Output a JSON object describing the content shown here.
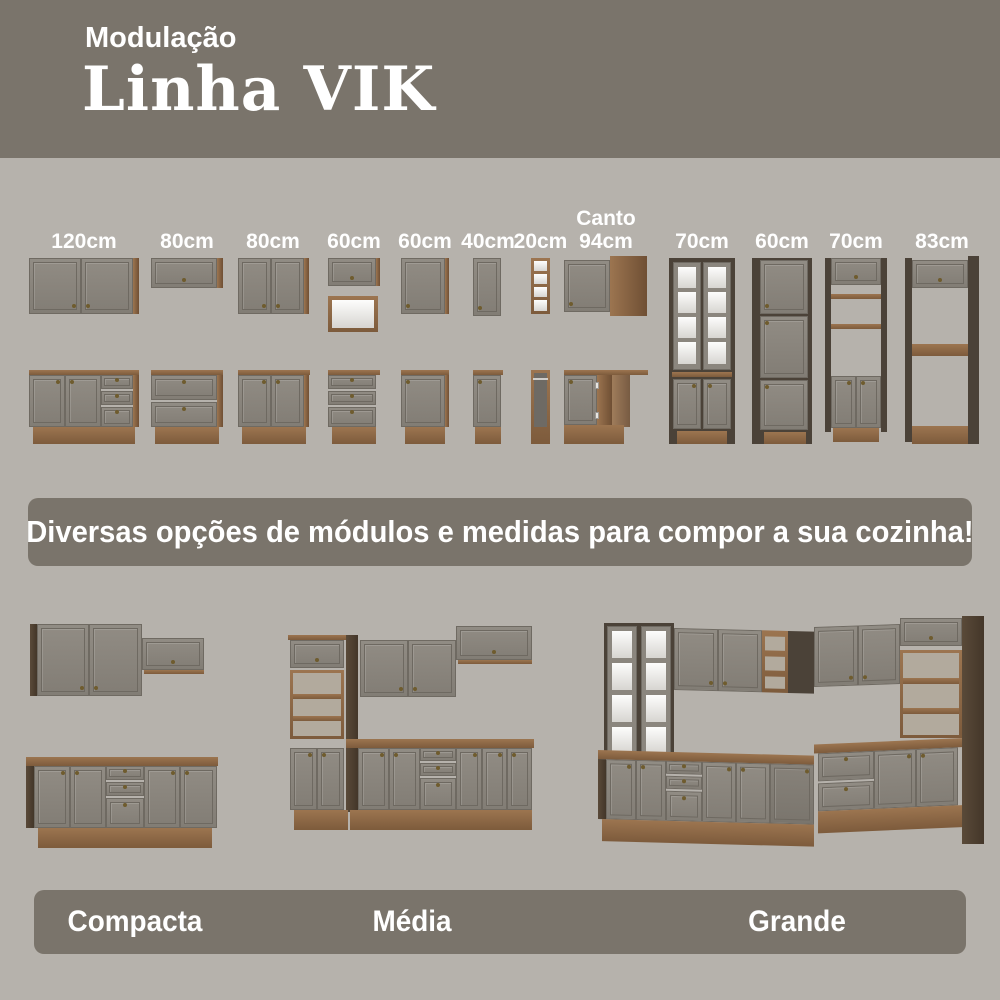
{
  "colors": {
    "background": "#b6b2ac",
    "panel": "#7a746b",
    "text_white": "#ffffff",
    "door_gray": "#8b867e",
    "door_frame": "#6f6a62",
    "wood_light": "#9c7550",
    "wood_dark": "#7d5b3c",
    "carcass_dark": "#4b4238",
    "glass_white": "#f2f1ee",
    "knob_brass": "#6f5c2e"
  },
  "header": {
    "kicker": "Modulação",
    "title": "Linha VIK"
  },
  "modules": {
    "items": [
      {
        "label": "120cm",
        "art": "wall-cabinet-2-doors + base-2-doors-3-drawers"
      },
      {
        "label": "80cm",
        "art": "wall-cabinet-flap-door + base-2-drawers"
      },
      {
        "label": "80cm",
        "art": "wall-cabinet-2-doors + base-2-doors"
      },
      {
        "label": "60cm",
        "art": "wall-flap-door-with-open-niche + base-3-drawers"
      },
      {
        "label": "60cm",
        "art": "wall-cabinet-1-door + base-1-door"
      },
      {
        "label": "40cm",
        "art": "wall-cabinet-1-door + base-1-door"
      },
      {
        "label": "20cm",
        "art": "open-shelf-column + open-base-with-rail"
      },
      {
        "label": "Canto\n94cm",
        "art": "corner-wall-cabinet + corner-base-cabinet"
      },
      {
        "label": "70cm",
        "art": "tall-glass-hutch"
      },
      {
        "label": "60cm",
        "art": "tall-pantry-cabinet"
      },
      {
        "label": "70cm",
        "art": "tall-oven-tower-open-middle"
      },
      {
        "label": "83cm",
        "art": "tall-fridge-surround-frame"
      }
    ]
  },
  "banner": {
    "text": "Diversas opções de módulos e medidas para compor a sua cozinha!"
  },
  "kitchens": {
    "items": [
      {
        "label": "Compacta"
      },
      {
        "label": "Média"
      },
      {
        "label": "Grande"
      }
    ]
  }
}
